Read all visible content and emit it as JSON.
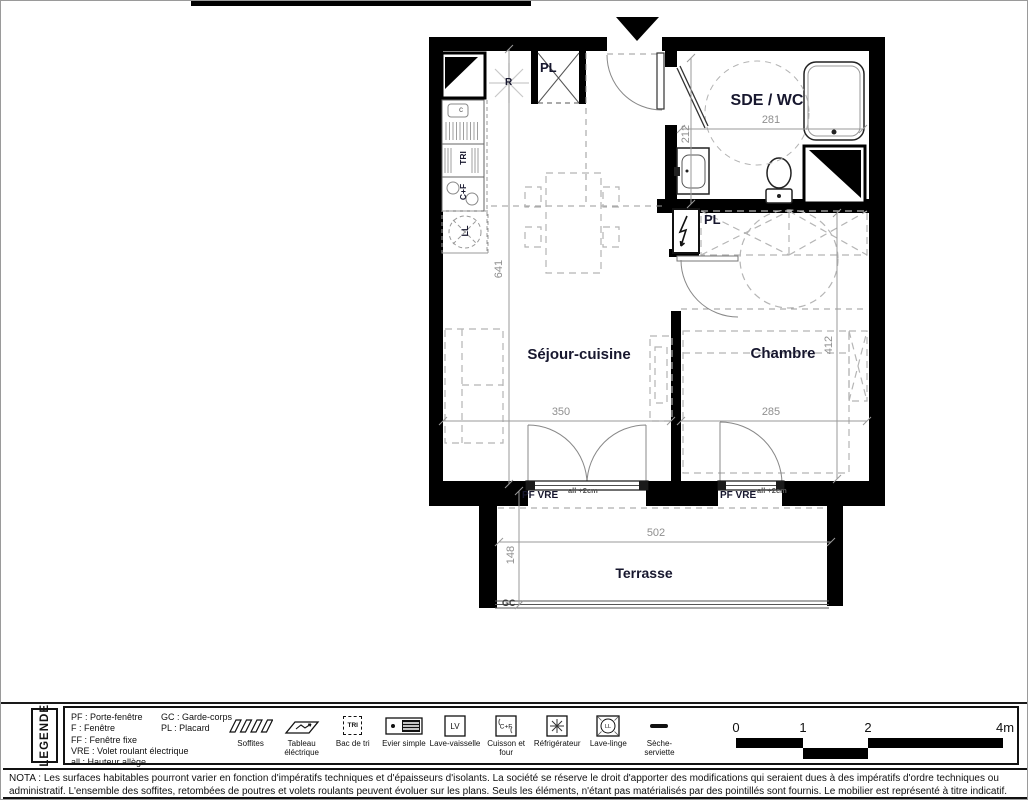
{
  "plan": {
    "rooms": {
      "sejour": "Séjour-cuisine",
      "chambre": "Chambre",
      "sde_wc": "SDE / WC",
      "terrasse": "Terrasse"
    },
    "fixtures": {
      "placard_kitchen": "PL",
      "placard_chambre": "PL",
      "fridge": "R",
      "sink_c": "c",
      "tri": "TRI",
      "cuisson": "C+F",
      "lave_linge": "LL",
      "garde_corps": "GC"
    },
    "windows": {
      "sejour_label": "PF VRE",
      "sejour_note": "all +2cm",
      "chambre_label": "PF VRE",
      "chambre_note": "all +2cm"
    },
    "dims": {
      "sejour_height": "641",
      "sejour_width": "350",
      "chambre_width": "285",
      "chambre_height": "412",
      "sde_width": "281",
      "sde_height": "212",
      "terrasse_width": "502",
      "terrasse_depth": "148"
    }
  },
  "legend": {
    "title": "LEGENDE",
    "abbreviations_col1": [
      "PF : Porte-fenêtre",
      "F : Fenêtre",
      "FF : Fenêtre fixe",
      "VRE : Volet roulant électrique",
      "all : Hauteur allège"
    ],
    "abbreviations_col2": [
      "GC : Garde-corps",
      "PL : Placard"
    ],
    "items": [
      {
        "name": "soffites",
        "label": "Soffites"
      },
      {
        "name": "tableau-electrique",
        "label": "Tableau éléctrique"
      },
      {
        "name": "bac-de-tri",
        "label": "Bac de tri",
        "icon_text": "TRI"
      },
      {
        "name": "evier-simple",
        "label": "Evier simple"
      },
      {
        "name": "lave-vaisselle",
        "label": "Lave-vaisselle",
        "icon_text": "LV"
      },
      {
        "name": "cuisson-et-four",
        "label": "Cuisson et four",
        "icon_text": "C+F"
      },
      {
        "name": "refrigerateur",
        "label": "Réfrigérateur"
      },
      {
        "name": "lave-linge",
        "label": "Lave-linge",
        "icon_text": "LL"
      },
      {
        "name": "seche-serviette",
        "label": "Sèche-serviette"
      }
    ],
    "scale": {
      "t0": "0",
      "t1": "1",
      "t2": "2",
      "t4": "4m"
    }
  },
  "nota": "NOTA : Les surfaces habitables pourront varier en fonction d'impératifs techniques et d'épaisseurs d'isolants. La société se réserve le droit d'apporter des modifications qui seraient dues à des impératifs d'ordre techniques ou administratif. L'ensemble des soffites, retombées de poutres et volets roulants peuvent évoluer sur les plans. Seuls les éléments, n'étant pas matérialisés par des pointillés sont fournis. Le mobilier est représenté à titre indicatif."
}
